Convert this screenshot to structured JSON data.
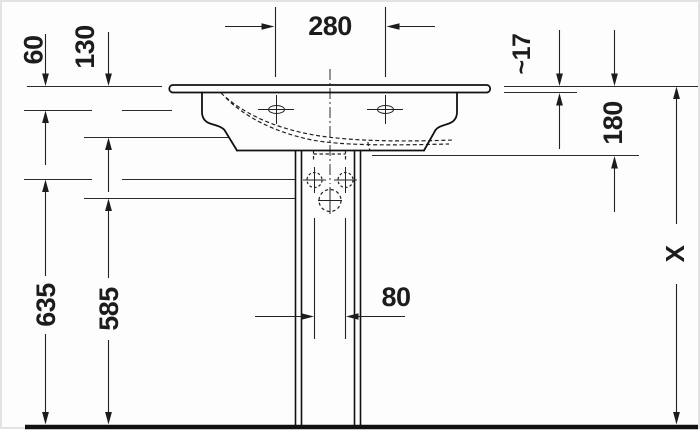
{
  "drawing": {
    "type": "technical-dimension-drawing",
    "subject": "pedestal washbasin front sectional elevation",
    "colors": {
      "line": "#1c1c1c",
      "background": "#fdfdfd",
      "border": "#e3e3e3"
    },
    "labels": {
      "tap_hole_spacing": "280",
      "rim_to_upper_ref": "60",
      "rim_to_mid_ref": "130",
      "rim_thickness": "~17",
      "rim_to_underside": "180",
      "fixing_holes_to_floor": "635",
      "drain_to_floor": "585",
      "fixing_hole_spacing": "80",
      "overall_height": "X"
    }
  }
}
